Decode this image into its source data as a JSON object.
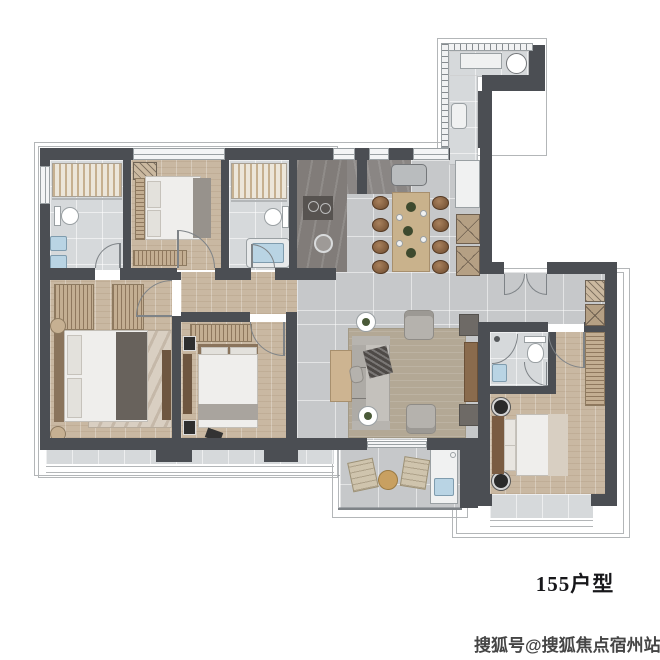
{
  "labels": {
    "plan_title": "155户型",
    "watermark": "搜狐号@搜狐焦点宿州站"
  },
  "palette": {
    "wall": "#4b4e53",
    "tile": "#d6d9db",
    "hall": "#c6c8ca",
    "wood": "#c9b8a2",
    "slat": "#c3ae92",
    "rugLiving": "#b3a895",
    "rugMaster": "#d9cfc2",
    "counter": "#817c79",
    "counterDark": "#575350",
    "blue": "#b9d4e4",
    "glass": "#7e8387",
    "outline": "#b3b6b8",
    "furnWhite": "#efeeec",
    "furnGray": "#b5b2ad",
    "furnDark": "#68625c",
    "headboard": "#8a745c",
    "tableWood": "#c9b28c"
  },
  "rooms": [
    "utility-balcony",
    "bathroom-1",
    "bedroom-2",
    "bathroom-2",
    "kitchen",
    "dining-area",
    "foyer-hallway",
    "master-bedroom",
    "bedroom-3",
    "living-room",
    "south-balcony",
    "suite-bedroom",
    "suite-bathroom"
  ]
}
